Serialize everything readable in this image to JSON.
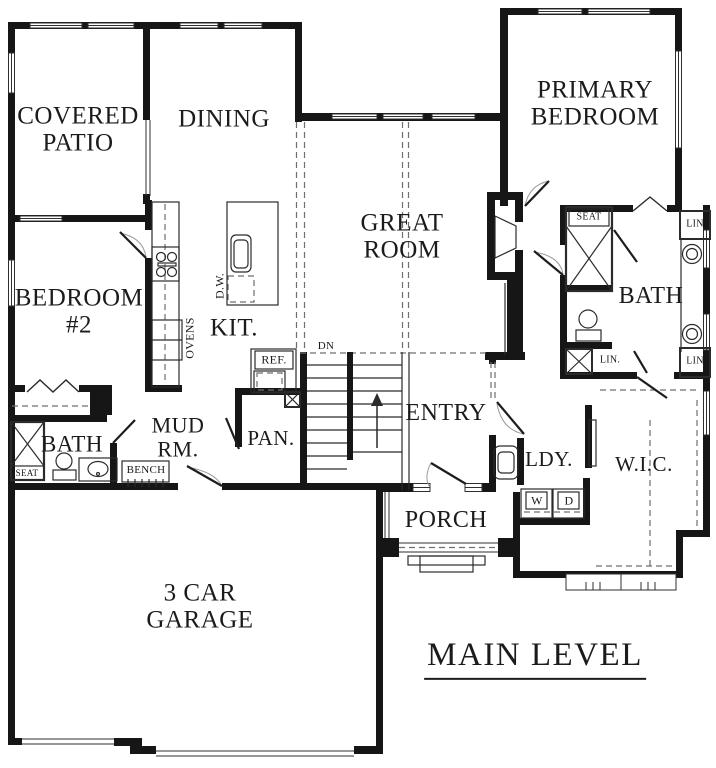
{
  "title": "MAIN LEVEL",
  "rooms": {
    "covered_patio": "COVERED\nPATIO",
    "dining": "DINING",
    "primary_bedroom": "PRIMARY\nBEDROOM",
    "great_room": "GREAT\nROOM",
    "bedroom_2": "BEDROOM\n#2",
    "kitchen": "KIT.",
    "bath_left": "BATH",
    "mud_room": "MUD\nRM.",
    "pantry": "PAN.",
    "entry": "ENTRY",
    "bath_primary": "BATH",
    "laundry": "LDY.",
    "walk_in_closet": "W.I.C.",
    "porch": "PORCH",
    "garage": "3 CAR\nGARAGE"
  },
  "fixtures": {
    "seat_primary_shower": "SEAT",
    "seat_hall_shower": "SEAT",
    "linen_top": "LIN",
    "linen_bottom": "LIN",
    "linen_closet": "LIN.",
    "bench": "BENCH",
    "ovens": "OVENS",
    "dishwasher": "D.W.",
    "refrigerator": "REF.",
    "stair_direction": "DN",
    "washer": "W",
    "dryer": "D"
  }
}
